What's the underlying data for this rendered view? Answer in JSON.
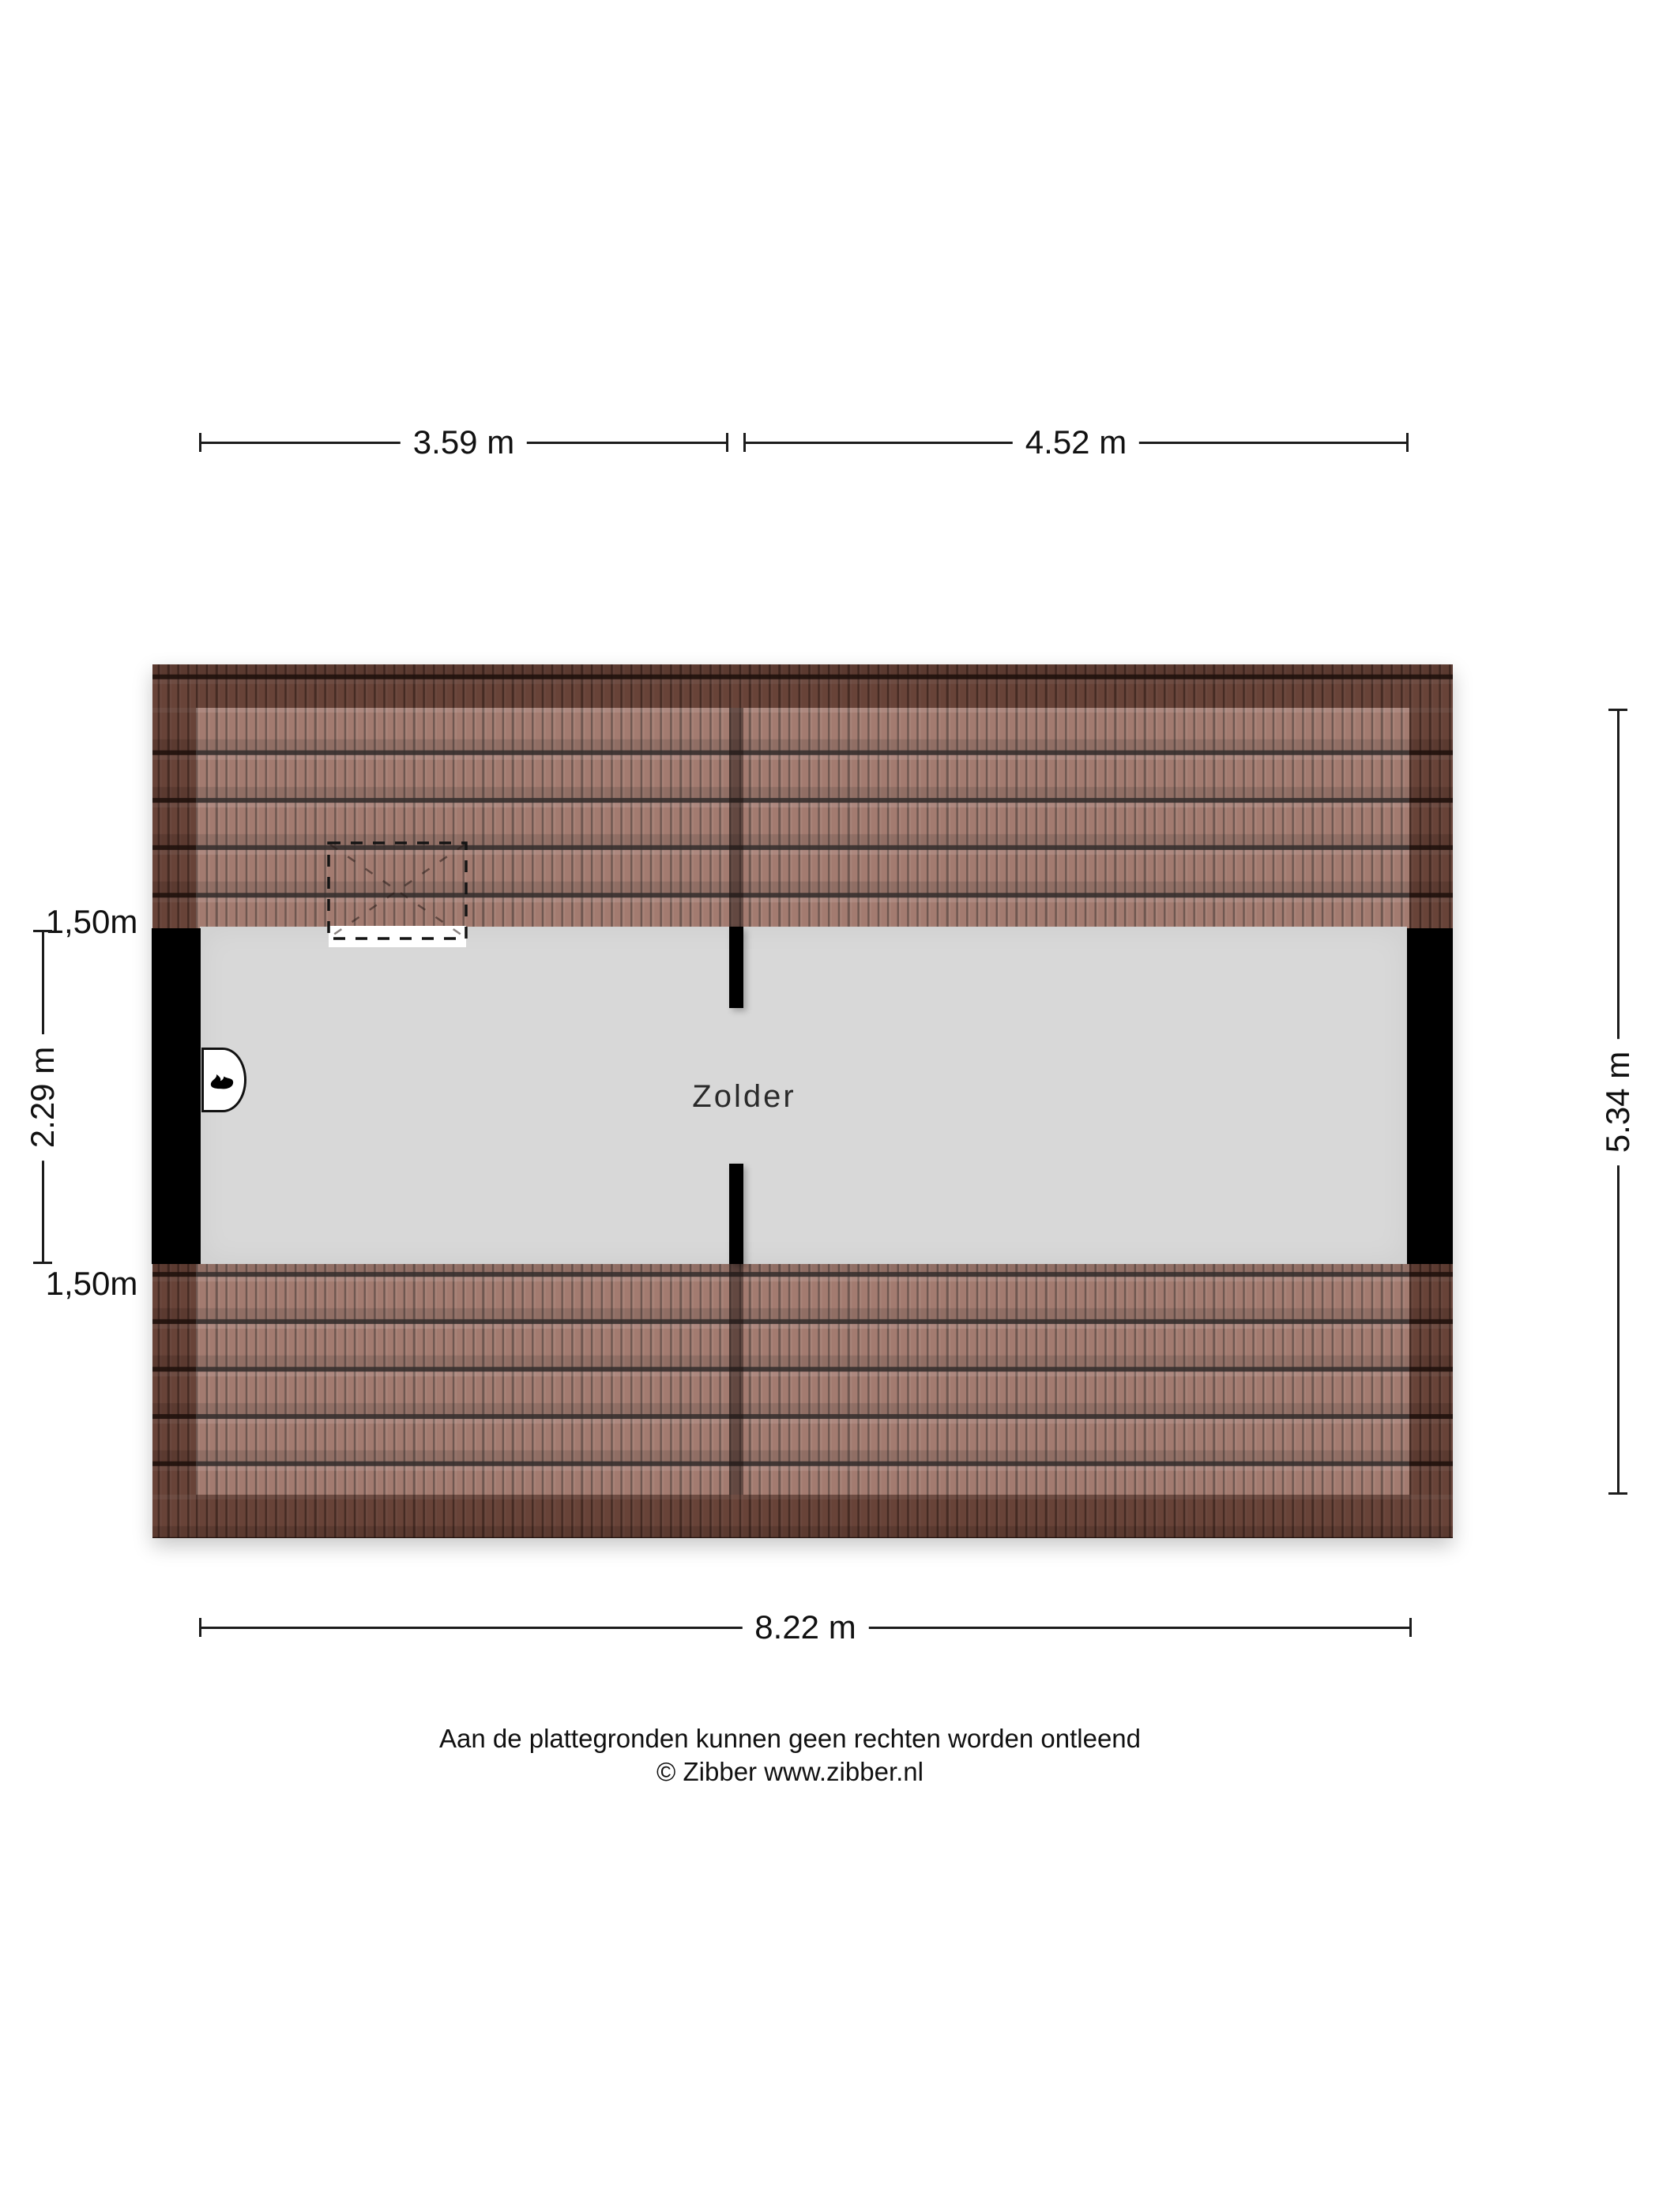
{
  "floorplan": {
    "room_label": "Zolder",
    "dimensions": {
      "top_left_width": "3.59 m",
      "top_right_width": "4.52 m",
      "total_width": "8.22 m",
      "roof_band_top": "1,50m",
      "room_depth": "2.29 m",
      "roof_band_bottom": "1,50m",
      "total_depth": "5.34 m"
    },
    "icons": {
      "flame": "flame-icon (boiler / water heater symbol)",
      "skylight": "dashed roof-window symbol"
    },
    "colors": {
      "roof_tile": "#96685b",
      "roof_edge_band": "#5e3c30",
      "floor": "#d8d8d8",
      "wall": "#000000",
      "dimension_line": "#1c1c1c",
      "background": "#ffffff"
    }
  },
  "footer": {
    "disclaimer": "Aan de plattegronden kunnen geen rechten worden ontleend",
    "copyright": "© Zibber www.zibber.nl"
  }
}
